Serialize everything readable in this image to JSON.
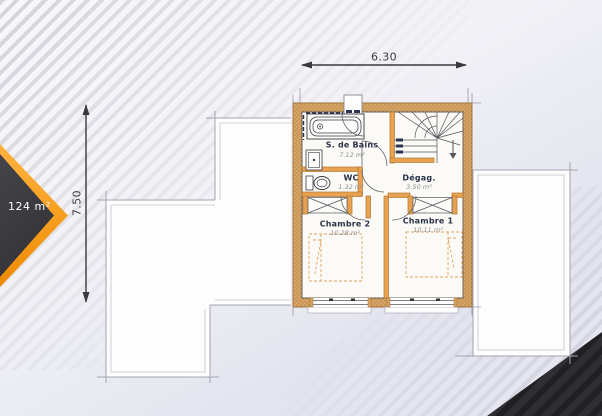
{
  "badge": {
    "area": "124 m²"
  },
  "dimensions": {
    "width": "6.30",
    "height": "7.50"
  },
  "rooms": {
    "bathroom": {
      "name": "S. de Bains",
      "area": "7.12 m²"
    },
    "wc": {
      "name": "WC",
      "area": "1.32 m²"
    },
    "landing": {
      "name": "Dégag.",
      "area": "3.50 m²"
    },
    "bedroom2": {
      "name": "Chambre 2",
      "area": "10.28 m²"
    },
    "bedroom1": {
      "name": "Chambre 1",
      "area": "10.11 m²"
    }
  },
  "colors": {
    "wall": "#d9a25f",
    "partition": "#e7a151",
    "accent_orange": "#f59a0c",
    "dark_corner": "#2b2b2f",
    "roof_fill": "#fdfdfe"
  }
}
